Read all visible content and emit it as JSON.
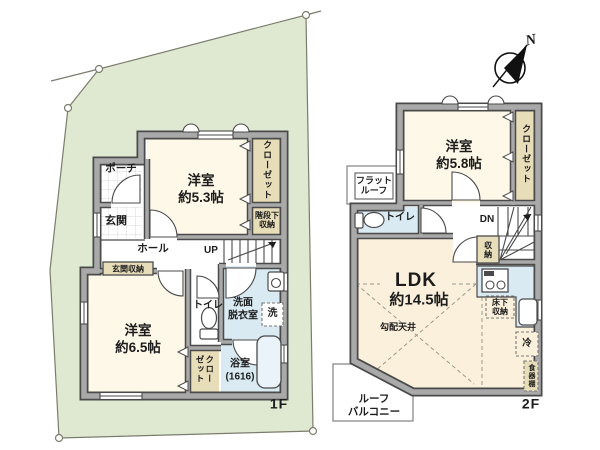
{
  "palette": {
    "site_green": "#dfe9d2",
    "wall_gray": "#a9a9a9",
    "wall_outline": "#4a4a4a",
    "room_cream": "#fdf8e7",
    "ldk_cream": "#faf0dc",
    "closet_tan": "#e8ddb9",
    "water_blue": "#d9eaf3",
    "text": "#1c1c1c"
  },
  "compass": {
    "north_label": "N"
  },
  "floor1": {
    "floor_label": "1F",
    "porch": "ポーチ",
    "genkan": "玄関",
    "hall": "ホール",
    "up": "UP",
    "room_5_3": "洋室\n約5.3帖",
    "closet": "クローゼット",
    "under_stairs_storage": "階段下\n収納",
    "entrance_storage": "玄関収納",
    "room_6_5": "洋室\n約6.5帖",
    "toilet": "トイレ",
    "closet2": "クローゼット",
    "washroom": "洗面\n脱衣室",
    "washer": "洗",
    "bath": "浴室\n(1616)"
  },
  "floor2": {
    "floor_label": "2F",
    "room_5_8": "洋室\n約5.8帖",
    "closet": "クローゼット",
    "flat_roof": "フラット\nルーフ",
    "toilet": "トイレ",
    "dn": "DN",
    "storage": "収納",
    "ldk": "LDK",
    "ldk_size": "約14.5帖",
    "sloped_ceiling": "勾配天井",
    "floor_storage": "床下\n収納",
    "fridge": "冷",
    "cupboard": "食器棚",
    "roof_balcony": "ルーフ\nバルコニー"
  }
}
